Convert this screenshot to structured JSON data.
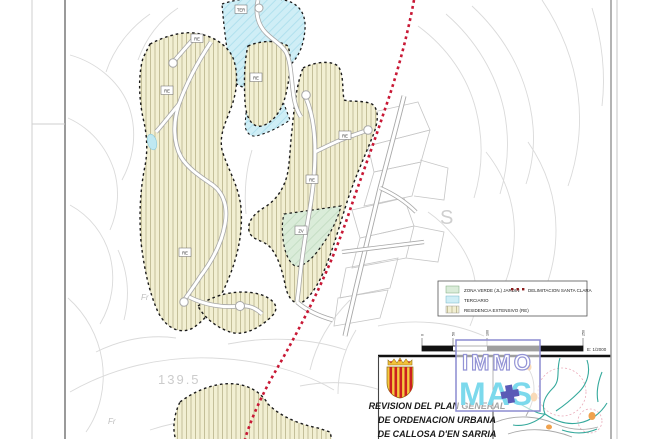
{
  "legend": {
    "items": [
      {
        "label": "ZONA VERDE (JL) JARDIN"
      },
      {
        "label": "TERCIARIO"
      },
      {
        "label": "RESIDENCIA EXTENSIVO (RE)"
      },
      {
        "label": "DELIMITACION SANTA CLARA"
      }
    ]
  },
  "scalebar": {
    "ticks": [
      "0",
      "50",
      "100",
      "250"
    ],
    "scale_text": "E: 1/2000"
  },
  "title_block": {
    "lines": [
      "REVISION DEL PLAN GENERAL",
      "DE ORDENACION URBANA",
      "DE CALLOSA D'EN SARRIA"
    ]
  },
  "watermark": {
    "line1": "IMMO",
    "line2": "MAS"
  },
  "map_labels": {
    "zone_re": "RE",
    "zone_zv": "ZV",
    "zone_ter": "TER",
    "elevation": "139.5",
    "fr": "Fr",
    "terrain_letter": "S"
  },
  "colors": {
    "residencial_fill": "#f2efd2",
    "residencial_hatch": "#b9b38b",
    "terciario_fill": "#cfeef6",
    "terciario_hatch": "#aadeed",
    "zona_verde_fill": "#daecd9",
    "delimitacion_red": "#c81835",
    "watermark_border": "#8c8cd0",
    "watermark_mas": "#7cd9ec",
    "watermark_cross": "#5a5ab6",
    "contour_gray": "#dadada"
  }
}
